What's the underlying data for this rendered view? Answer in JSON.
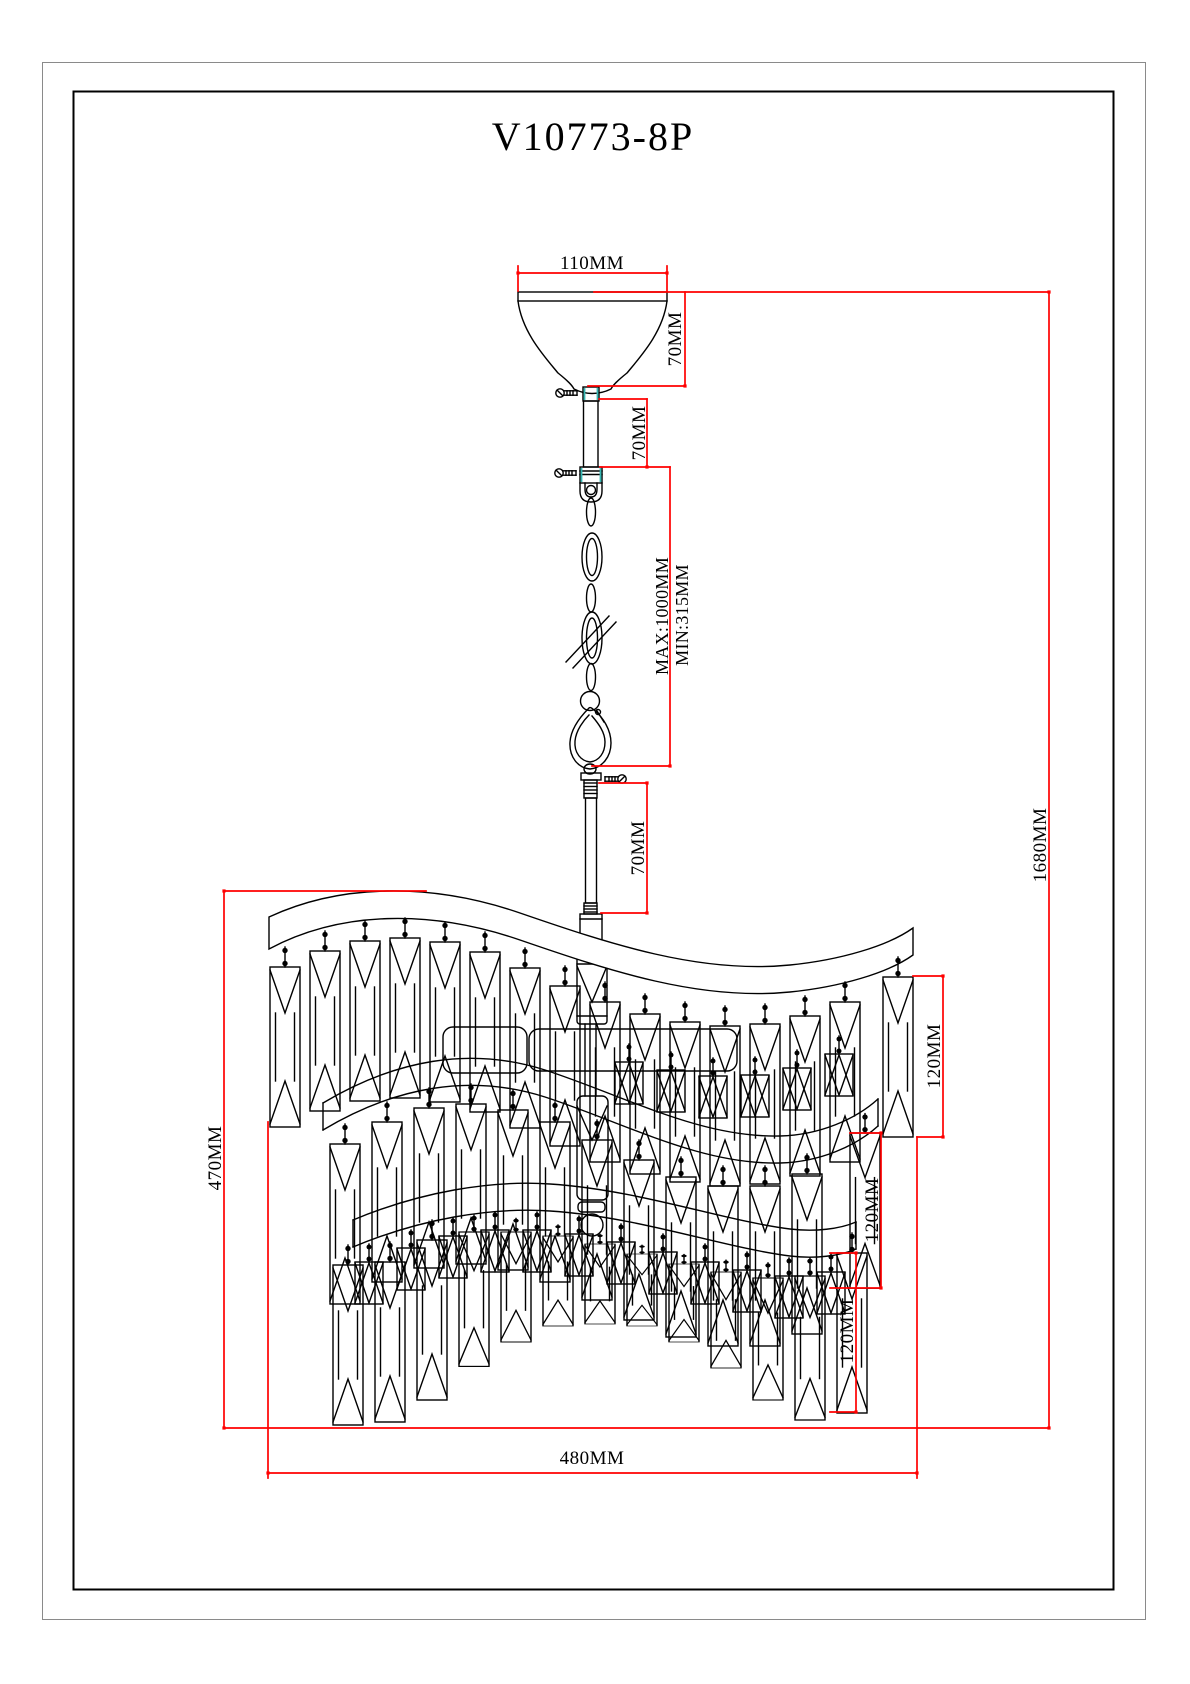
{
  "drawing": {
    "title": "V10773-8P"
  },
  "dimensions": {
    "canopy_width": "110MM",
    "canopy_height": "70MM",
    "stem_upper": "70MM",
    "chain_max": "MAX:1000MM",
    "chain_min": "MIN:315MM",
    "stem_lower": "70MM",
    "overall_height": "1680MM",
    "body_height": "470MM",
    "body_width": "480MM",
    "tier1_crystal_height": "120MM",
    "tier2_crystal_height": "120MM",
    "tier3_crystal_height": "120MM"
  },
  "colors": {
    "dimension_lines": "#ff0000",
    "drawing_lines": "#000000",
    "connector_accent": "#35b6b2"
  }
}
